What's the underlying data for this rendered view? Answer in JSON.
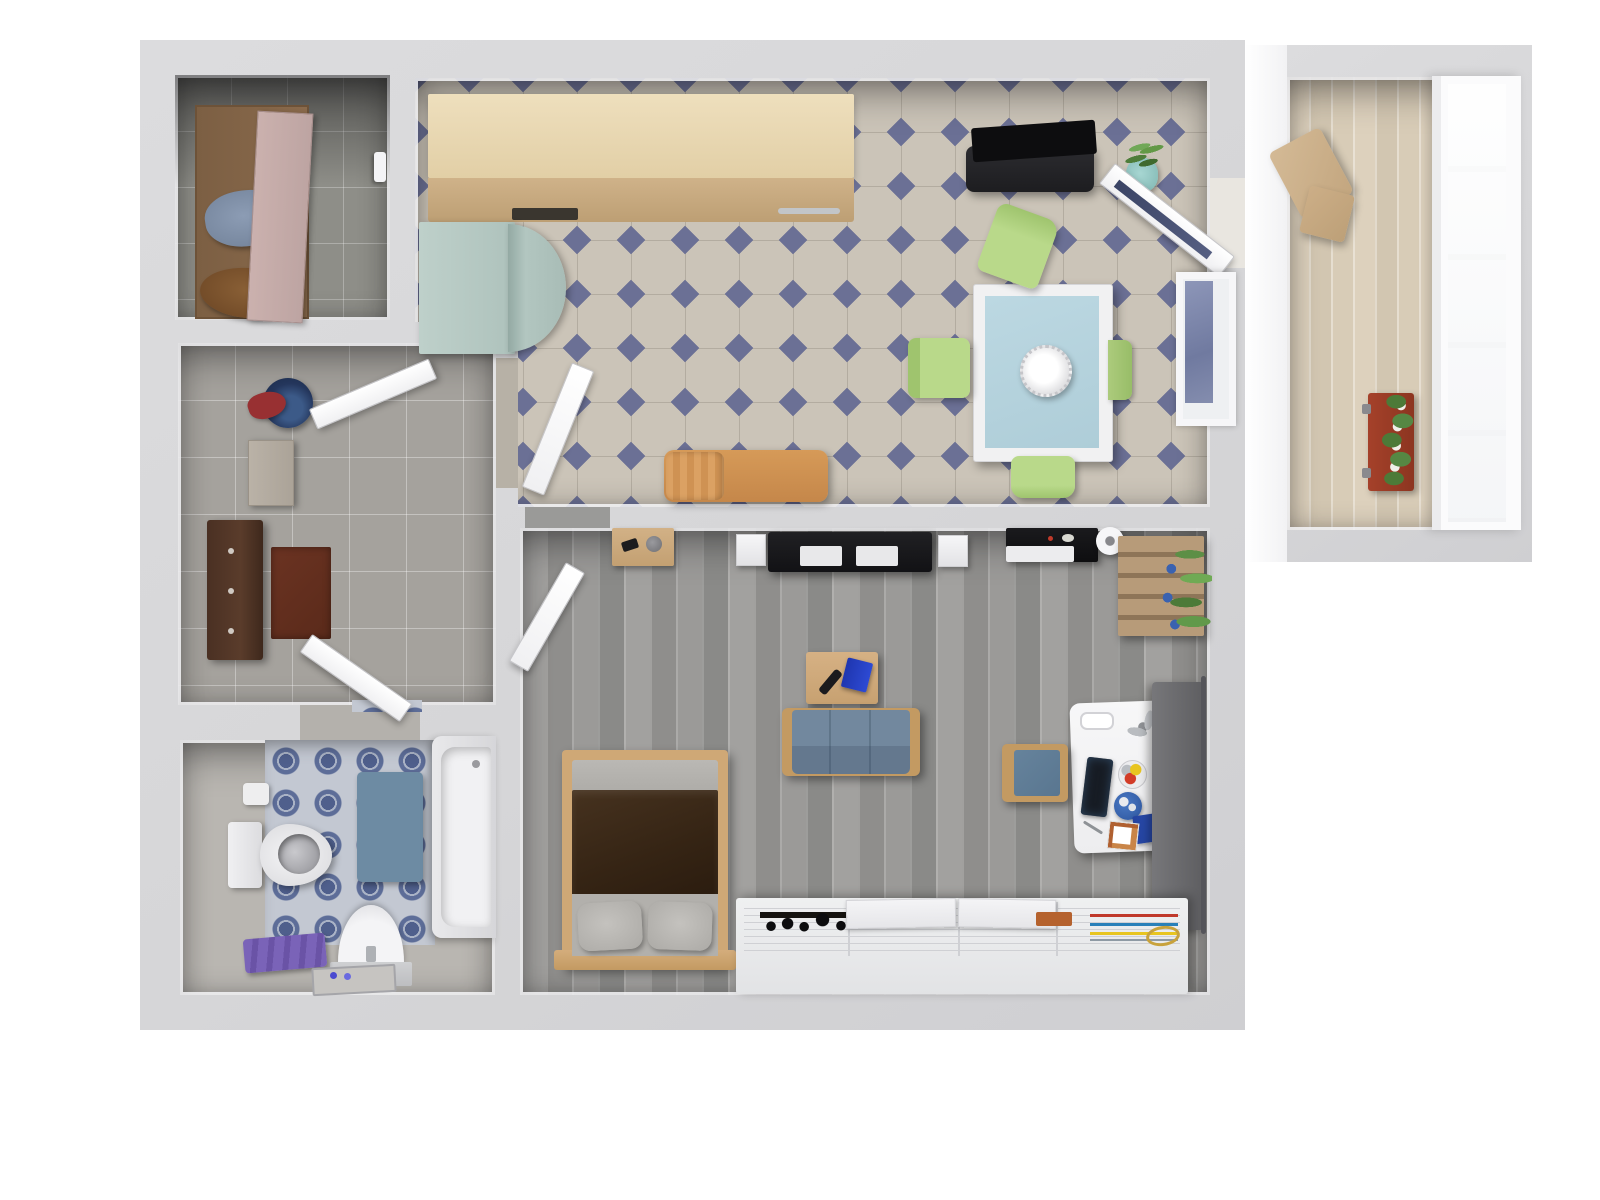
{
  "title": "Top-down 3D apartment floor plan render",
  "colors": {
    "background": "#ffffff",
    "wall": "#d8d8da",
    "wall_highlight": "#f4f4f6",
    "closet_floor": "#8e8e88",
    "hall_floor": "#a5a29d",
    "bath_floor": "#b9b6b1",
    "bath_tile_blue": "#55648e",
    "kitchen_tile_beige": "#cbc4b8",
    "kitchen_tile_diamond": "#6b7095",
    "living_floor_wood": "#979795",
    "balcony_floor_wood": "#d9cdb9",
    "counter_wood": "#e8d5b0",
    "fridge_mint": "#b6cac4",
    "table_top_blue": "#b7d3dd",
    "chair_green": "#b9d98a",
    "sofa_blue": "#7189a0",
    "bed_wood": "#cfa876",
    "blanket_brown": "#3a2a1f",
    "door_mat_red": "#612c1d",
    "bath_mat_blue": "#6d8ba3",
    "towel_purple": "#7a63b8",
    "flower_box_terracotta": "#993b24",
    "plant_green": "#5d8f46",
    "sideboard_black": "#1d1d20"
  },
  "rooms": [
    {
      "name": "closet",
      "floor": "grey ceramic tile",
      "furniture": [
        "open-wardrobe",
        "wardrobe-door",
        "blue-towel",
        "brown-towel",
        "shower-handle"
      ]
    },
    {
      "name": "hallway",
      "floor": "grey ceramic tile",
      "furniture": [
        "storage-bucket",
        "red-cloth",
        "entry-door",
        "shoe-cabinet",
        "coat-rack",
        "door-mat",
        "bathroom-door",
        "tile-threshold"
      ]
    },
    {
      "name": "bathroom",
      "floor": "grey tile with blue patterned inset",
      "furniture": [
        "patterned-tile-area",
        "toilet",
        "toilet-tank",
        "toilet-paper-holder",
        "bath-mat",
        "bathtub",
        "pedestal-sink",
        "purple-towels",
        "floor-tray"
      ]
    },
    {
      "name": "kitchen-dining",
      "floor": "beige tile with blue diamond accents",
      "furniture": [
        "kitchen-counter",
        "counter-front",
        "oven-recess",
        "counter-handle",
        "refrigerator",
        "fridge-door",
        "black-sideboard",
        "potted-plant",
        "balcony-door",
        "window",
        "dining-table",
        "centerpiece-bowl",
        "chair-north",
        "chair-west",
        "chair-east",
        "chair-south",
        "wooden-bench",
        "kitchen-door"
      ]
    },
    {
      "name": "living-room",
      "floor": "grey wood planks",
      "furniture": [
        "wall-shelf-desk",
        "speaker-left",
        "tv-unit",
        "speaker-right",
        "audio-shelf",
        "round-speaker",
        "pallet-shelf",
        "shelf-plant",
        "room-door",
        "bed",
        "blanket",
        "pillows",
        "coffee-table",
        "remote-control",
        "blue-notebook",
        "sofa",
        "desk",
        "desk-lamp",
        "tablet",
        "globe",
        "color-wheel",
        "desk-notebook",
        "desk-chair",
        "curtain-rug",
        "curtain-rod",
        "storage-organizer",
        "organizer-lids",
        "orange-box"
      ]
    },
    {
      "name": "balcony",
      "floor": "light wood planks",
      "furniture": [
        "lounge-chair",
        "side-stool",
        "flower-box",
        "white-flowers",
        "window-wall"
      ]
    }
  ]
}
